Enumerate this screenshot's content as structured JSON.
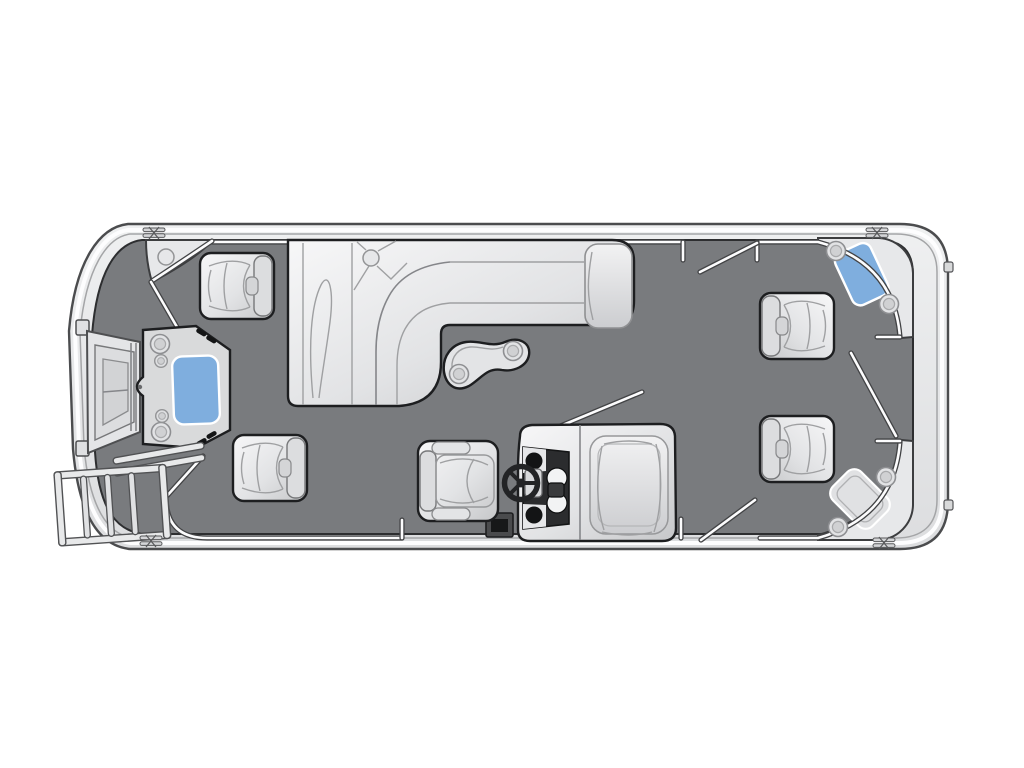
{
  "diagram": {
    "kind": "pontoon-boat-floorplan",
    "view": "top-down deck layout",
    "visible_text": []
  },
  "colors": {
    "page_bg": "#ffffff",
    "hull_fill": "#e9eaec",
    "hull_stroke": "#4b4c4e",
    "hull_inner_line": "#a4a5a7",
    "rub_rail_white": "#fdfdfe",
    "deck": "#797b7e",
    "deck_stroke": "#2d2e30",
    "furniture_light": "#f5f5f6",
    "furniture_dark": "#c6c7c9",
    "furniture_stroke": "#1d1e20",
    "seam_gray": "#9fa0a2",
    "accent_blue": "#7faede",
    "fence_white": "#fcfcfd",
    "fence_dark": "#424345",
    "panel_dark": "#2b2c2e"
  },
  "fence": {
    "segments": [
      {
        "id": "top-port-rail",
        "d": "M 212,242 H 683"
      },
      {
        "id": "top-aft-rail-and-corner",
        "d": "M 757,242 H 818 Q 894,262 900,337"
      },
      {
        "id": "bottom-port-rail-and-bow-curve",
        "d": "M 402,538 H 207 Q 167,538 166,499"
      },
      {
        "id": "bottom-aft-rail-and-corner",
        "d": "M 760,538 H 818 Q 894,517 900,442"
      },
      {
        "id": "bow-wedge-edge",
        "d": "M 212,241 Q 181,262 152,281"
      }
    ],
    "stubs": [
      {
        "d": "M 683,242 V 260"
      },
      {
        "d": "M 757,242 V 260"
      },
      {
        "d": "M 402,538 V 520"
      },
      {
        "d": "M 681,538 V 519"
      },
      {
        "d": "M 877,337 H 900"
      },
      {
        "d": "M 877,441 H 900"
      }
    ],
    "gate_doors": [
      {
        "id": "bow-port-gate-door",
        "d": "M 151,282 L 177,327"
      },
      {
        "id": "bow-starboard-gate-door",
        "d": "M 166,497 L 203,456"
      },
      {
        "id": "port-aft-gate-door",
        "d": "M 757,243 L 700,272"
      },
      {
        "id": "starboard-aft-gate-door",
        "d": "M 755,500 L 701,540"
      },
      {
        "id": "stern-gate-door",
        "d": "M 851,353 L 896,436"
      }
    ]
  },
  "furniture": {
    "chairs": [
      {
        "id": "bow-port-captain-chair",
        "x": 237,
        "y": 286,
        "facing": "left"
      },
      {
        "id": "bow-starboard-captain-chair",
        "x": 270,
        "y": 468,
        "facing": "left"
      },
      {
        "id": "aft-port-captain-chair",
        "x": 797,
        "y": 326,
        "facing": "right"
      },
      {
        "id": "aft-starboard-captain-chair",
        "x": 797,
        "y": 449,
        "facing": "right"
      }
    ],
    "lounges": [
      "port-l-shaped-lounge"
    ],
    "tables": [
      "bow-gate-table-blue",
      "kidney-cocktail-table",
      "port-aft-corner-table-blue",
      "starboard-aft-corner-seat"
    ],
    "helm": [
      "helm-console",
      "steering-wheel",
      "helm-captain-chair",
      "instrument-panel"
    ]
  },
  "deck_hardware": {
    "cleats": [
      {
        "x": 154,
        "y": 233
      },
      {
        "x": 877,
        "y": 233
      },
      {
        "x": 151,
        "y": 541
      },
      {
        "x": 884,
        "y": 543
      }
    ],
    "side_tabs": [
      {
        "x": 944,
        "y": 262
      },
      {
        "x": 944,
        "y": 500
      }
    ],
    "cupholders_lg": [
      {
        "x": 160,
        "y": 344
      },
      {
        "x": 161,
        "y": 432
      },
      {
        "x": 459,
        "y": 374
      },
      {
        "x": 513,
        "y": 351
      },
      {
        "x": 836,
        "y": 251
      },
      {
        "x": 889,
        "y": 304
      },
      {
        "x": 886,
        "y": 477
      },
      {
        "x": 838,
        "y": 527
      }
    ],
    "cupholders_md": [
      {
        "x": 371,
        "y": 258
      },
      {
        "x": 166,
        "y": 257
      }
    ],
    "cupholders_sm": [
      {
        "x": 161,
        "y": 361
      },
      {
        "x": 162,
        "y": 416
      }
    ]
  }
}
